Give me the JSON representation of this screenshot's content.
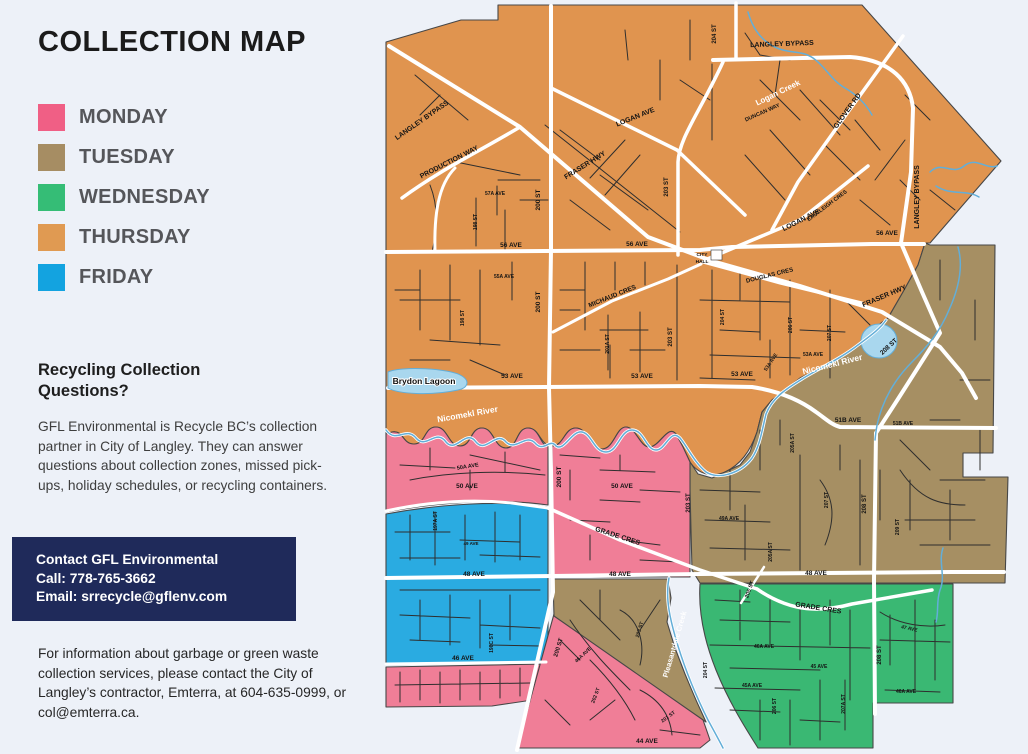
{
  "title": "COLLECTION MAP",
  "legend": {
    "items": [
      {
        "label": "MONDAY",
        "color": "#f05f85"
      },
      {
        "label": "TUESDAY",
        "color": "#a68d63"
      },
      {
        "label": "WEDNESDAY",
        "color": "#35bd76"
      },
      {
        "label": "THURSDAY",
        "color": "#e09a52"
      },
      {
        "label": "FRIDAY",
        "color": "#13a3e0"
      }
    ]
  },
  "recycling": {
    "heading": "Recycling Collection Questions?",
    "body": "GFL Environmental is Recycle BC’s collection partner in City of Langley. They can answer questions about collection zones, missed pick-ups, holiday schedules, or recycling containers."
  },
  "contact": {
    "background": "#1f2a5a",
    "line1": "Contact GFL Environmental",
    "line2": "Call: 778-765-3662",
    "line3": "Email: srrecycle@gflenv.com"
  },
  "garbage_info": "For information about garbage or green waste collection services, please contact the City of Langley’s contractor, Emterra, at 604-635-0999, or col@emterra.ca.",
  "map": {
    "zone_colors": {
      "monday": "#f07e97",
      "tuesday": "#a68f63",
      "wednesday": "#3ab873",
      "thursday": "#e0944f",
      "friday": "#2aabe1"
    },
    "road_labels": [
      {
        "text": "204 ST",
        "x": 716,
        "y": 34,
        "r": -90,
        "s": 6
      },
      {
        "text": "LANGLEY BYPASS",
        "x": 782,
        "y": 46,
        "r": -2,
        "s": 7
      },
      {
        "text": "GLOVER RD",
        "x": 849,
        "y": 112,
        "r": -54,
        "s": 7
      },
      {
        "text": "DUNCAN WAY",
        "x": 763,
        "y": 114,
        "r": -24,
        "s": 5.5
      },
      {
        "text": "LANGLEY BYPASS",
        "x": 423,
        "y": 122,
        "r": -35,
        "s": 7
      },
      {
        "text": "LOGAN AVE",
        "x": 636,
        "y": 119,
        "r": -22,
        "s": 7
      },
      {
        "text": "PRODUCTION WAY",
        "x": 450,
        "y": 164,
        "r": -27,
        "s": 7
      },
      {
        "text": "FRASER HWY",
        "x": 586,
        "y": 167,
        "r": -32,
        "s": 7
      },
      {
        "text": "203 ST",
        "x": 668,
        "y": 187,
        "r": -90,
        "s": 6
      },
      {
        "text": "LOGAN AVE",
        "x": 802,
        "y": 222,
        "r": -27,
        "s": 7
      },
      {
        "text": "EASTLEIGH CRES",
        "x": 828,
        "y": 207,
        "r": -37,
        "s": 5.5
      },
      {
        "text": "LANGLEY BYPASS",
        "x": 919,
        "y": 197,
        "r": -90,
        "s": 7
      },
      {
        "text": "57A AVE",
        "x": 495,
        "y": 195,
        "r": 0,
        "s": 5
      },
      {
        "text": "198 ST",
        "x": 477,
        "y": 222,
        "r": -90,
        "s": 5
      },
      {
        "text": "200 ST",
        "x": 540,
        "y": 200,
        "r": -90,
        "s": 6.5
      },
      {
        "text": "56 AVE",
        "x": 511,
        "y": 247,
        "r": 0,
        "s": 6.5
      },
      {
        "text": "56 AVE",
        "x": 637,
        "y": 246,
        "r": 0,
        "s": 6.5
      },
      {
        "text": "56 AVE",
        "x": 887,
        "y": 235,
        "r": 0,
        "s": 6.5
      },
      {
        "text": "CITY",
        "x": 702,
        "y": 256,
        "r": 0,
        "s": 4.8
      },
      {
        "text": "HALL",
        "x": 702,
        "y": 263,
        "r": 0,
        "s": 4.8
      },
      {
        "text": "DOUGLAS CRES",
        "x": 770,
        "y": 277,
        "r": -14,
        "s": 6
      },
      {
        "text": "FRASER HWY",
        "x": 885,
        "y": 298,
        "r": -23,
        "s": 7
      },
      {
        "text": "55A AVE",
        "x": 504,
        "y": 278,
        "r": 0,
        "s": 5
      },
      {
        "text": "MICHAUD CRES",
        "x": 613,
        "y": 298,
        "r": -22,
        "s": 6.5
      },
      {
        "text": "200 ST",
        "x": 540,
        "y": 302,
        "r": -90,
        "s": 6.5
      },
      {
        "text": "204 ST",
        "x": 724,
        "y": 317,
        "r": -90,
        "s": 5
      },
      {
        "text": "206 ST",
        "x": 792,
        "y": 325,
        "r": -90,
        "s": 5
      },
      {
        "text": "207 ST",
        "x": 831,
        "y": 333,
        "r": -90,
        "s": 5
      },
      {
        "text": "203 ST",
        "x": 672,
        "y": 337,
        "r": -90,
        "s": 6
      },
      {
        "text": "201A ST",
        "x": 609,
        "y": 344,
        "r": -90,
        "s": 5
      },
      {
        "text": "198 ST",
        "x": 464,
        "y": 318,
        "r": -90,
        "s": 5
      },
      {
        "text": "53 AVE",
        "x": 512,
        "y": 378,
        "r": 0,
        "s": 6.5
      },
      {
        "text": "53 AVE",
        "x": 642,
        "y": 378,
        "r": 0,
        "s": 6.5
      },
      {
        "text": "53 AVE",
        "x": 742,
        "y": 376,
        "r": 0,
        "s": 6.5
      },
      {
        "text": "53A AVE",
        "x": 813,
        "y": 356,
        "r": 0,
        "s": 5
      },
      {
        "text": "53A AVE",
        "x": 772,
        "y": 363,
        "r": -56,
        "s": 5
      },
      {
        "text": "208 ST",
        "x": 890,
        "y": 348,
        "r": -43,
        "s": 6.5
      },
      {
        "text": "51B AVE",
        "x": 848,
        "y": 422,
        "r": 0,
        "s": 6.5
      },
      {
        "text": "51B AVE",
        "x": 903,
        "y": 425,
        "r": 0,
        "s": 5
      },
      {
        "text": "205A ST",
        "x": 794,
        "y": 443,
        "r": -90,
        "s": 5
      },
      {
        "text": "49A AVE",
        "x": 729,
        "y": 520,
        "r": 0,
        "s": 5
      },
      {
        "text": "207 ST",
        "x": 828,
        "y": 500,
        "r": -90,
        "s": 5
      },
      {
        "text": "208 ST",
        "x": 866,
        "y": 504,
        "r": -90,
        "s": 6
      },
      {
        "text": "209 ST",
        "x": 899,
        "y": 527,
        "r": -90,
        "s": 5
      },
      {
        "text": "205A ST",
        "x": 772,
        "y": 552,
        "r": -90,
        "s": 5
      },
      {
        "text": "50A AVE",
        "x": 468,
        "y": 468,
        "r": -9,
        "s": 5.5
      },
      {
        "text": "50 AVE",
        "x": 467,
        "y": 488,
        "r": 0,
        "s": 6.5
      },
      {
        "text": "50 AVE",
        "x": 622,
        "y": 488,
        "r": 0,
        "s": 6.5
      },
      {
        "text": "200 ST",
        "x": 561,
        "y": 477,
        "r": -90,
        "s": 6.5
      },
      {
        "text": "203 ST",
        "x": 690,
        "y": 503,
        "r": -90,
        "s": 6
      },
      {
        "text": "197A ST",
        "x": 437,
        "y": 521,
        "r": -90,
        "s": 5
      },
      {
        "text": "49 AVE",
        "x": 471,
        "y": 545,
        "r": 0,
        "s": 4.5
      },
      {
        "text": "GRADE CRES",
        "x": 617,
        "y": 538,
        "r": 18,
        "s": 7
      },
      {
        "text": "48 AVE",
        "x": 474,
        "y": 576,
        "r": 0,
        "s": 6.5
      },
      {
        "text": "48 AVE",
        "x": 620,
        "y": 576,
        "r": 0,
        "s": 6.5
      },
      {
        "text": "48 AVE",
        "x": 816,
        "y": 575,
        "r": 0,
        "s": 6.5
      },
      {
        "text": "205 ST",
        "x": 751,
        "y": 590,
        "r": -70,
        "s": 5.5
      },
      {
        "text": "GRADE CRES",
        "x": 818,
        "y": 610,
        "r": 9,
        "s": 7
      },
      {
        "text": "47 AVE",
        "x": 909,
        "y": 630,
        "r": 12,
        "s": 5
      },
      {
        "text": "46A AVE",
        "x": 764,
        "y": 648,
        "r": 0,
        "s": 5
      },
      {
        "text": "45 AVE",
        "x": 819,
        "y": 668,
        "r": 0,
        "s": 5
      },
      {
        "text": "45A AVE",
        "x": 752,
        "y": 687,
        "r": 0,
        "s": 5
      },
      {
        "text": "46A AVE",
        "x": 906,
        "y": 693,
        "r": 0,
        "s": 5
      },
      {
        "text": "204 ST",
        "x": 707,
        "y": 670,
        "r": -90,
        "s": 5
      },
      {
        "text": "206 ST",
        "x": 776,
        "y": 706,
        "r": -90,
        "s": 5
      },
      {
        "text": "207A ST",
        "x": 845,
        "y": 704,
        "r": -90,
        "s": 5
      },
      {
        "text": "208 ST",
        "x": 881,
        "y": 655,
        "r": -90,
        "s": 6
      },
      {
        "text": "46 AVE",
        "x": 463,
        "y": 660,
        "r": 0,
        "s": 6.5
      },
      {
        "text": "198C ST",
        "x": 493,
        "y": 643,
        "r": -90,
        "s": 5
      },
      {
        "text": "200 ST",
        "x": 560,
        "y": 648,
        "r": -73,
        "s": 6
      },
      {
        "text": "46A AVE",
        "x": 584,
        "y": 656,
        "r": -43,
        "s": 5
      },
      {
        "text": "202 ST",
        "x": 597,
        "y": 696,
        "r": -69,
        "s": 5
      },
      {
        "text": "201 ST",
        "x": 669,
        "y": 718,
        "r": -36,
        "s": 5
      },
      {
        "text": "203 ST",
        "x": 641,
        "y": 630,
        "r": -73,
        "s": 5
      },
      {
        "text": "44 AVE",
        "x": 647,
        "y": 743,
        "r": 0,
        "s": 6.5
      }
    ],
    "water_labels": [
      {
        "text": "Logan Creek",
        "x": 779,
        "y": 95,
        "r": -26,
        "s": 8,
        "style": "white"
      },
      {
        "text": "Nicomekl River",
        "x": 468,
        "y": 417,
        "r": -10,
        "s": 8.5,
        "style": "white"
      },
      {
        "text": "Nicomekl River",
        "x": 833,
        "y": 367,
        "r": -14,
        "s": 8.5,
        "style": "white"
      },
      {
        "text": "Pleasantdale Creek",
        "x": 677,
        "y": 645,
        "r": -74,
        "s": 7.5,
        "style": "white"
      },
      {
        "text": "Brydon Lagoon",
        "x": 424,
        "y": 384,
        "r": 0,
        "s": 8.5,
        "style": "dark-halo"
      }
    ]
  }
}
